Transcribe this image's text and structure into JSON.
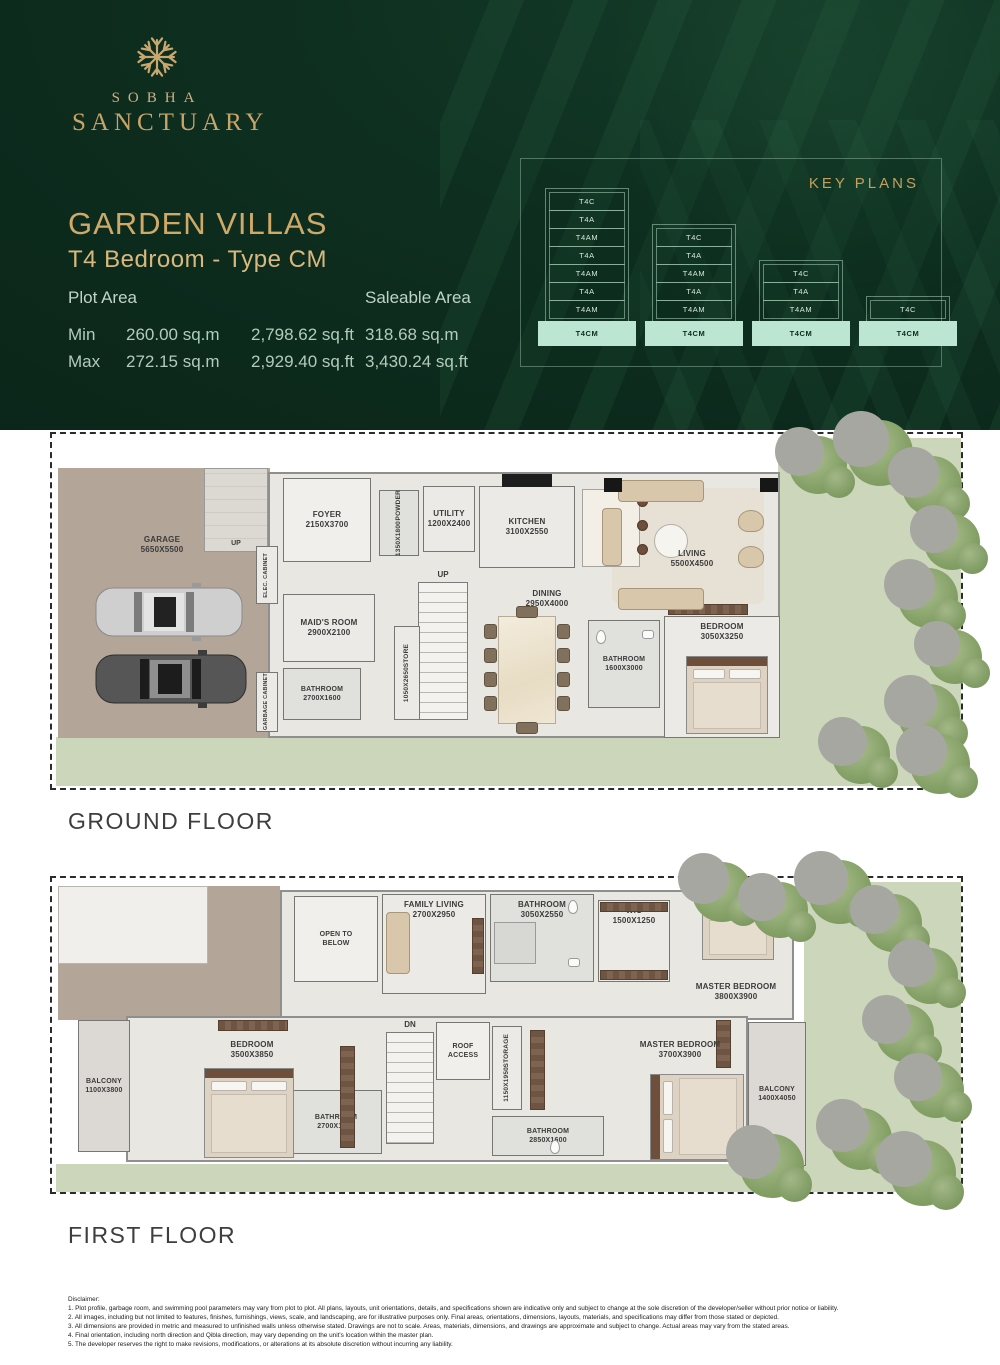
{
  "brand": {
    "name_top": "SOBHA",
    "name_bottom": "SANCTUARY"
  },
  "colors": {
    "header_green": "#0e2f20",
    "brand_gold": "#c9a468",
    "keyplan_highlight": "#bce6d1",
    "garden_green": "#ccd6ba",
    "garage_tan": "#b3a597"
  },
  "header": {
    "title": "GARDEN VILLAS",
    "subtitle": "T4 Bedroom - Type CM",
    "plot_area": {
      "label": "Plot Area",
      "rows": [
        {
          "key": "Min",
          "sqm": "260.00 sq.m",
          "sqft": "2,798.62 sq.ft"
        },
        {
          "key": "Max",
          "sqm": "272.15 sq.m",
          "sqft": "2,929.40 sq.ft"
        }
      ]
    },
    "saleable_area": {
      "label": "Saleable Area",
      "rows": [
        "318.68 sq.m",
        "3,430.24 sq.ft"
      ]
    }
  },
  "key_plans": {
    "title": "KEY PLANS",
    "stacks": [
      {
        "units": [
          "T4C",
          "T4A",
          "T4AM",
          "T4A",
          "T4AM",
          "T4A",
          "T4AM"
        ],
        "highlighted": "T4CM"
      },
      {
        "units": [
          "T4C",
          "T4A",
          "T4AM",
          "T4A",
          "T4AM"
        ],
        "highlighted": "T4CM"
      },
      {
        "units": [
          "T4C",
          "T4A",
          "T4AM"
        ],
        "highlighted": "T4CM"
      },
      {
        "units": [
          "T4C"
        ],
        "highlighted": "T4CM"
      }
    ]
  },
  "ground": {
    "label": "GROUND FLOOR",
    "rooms": {
      "garage": {
        "name": "GARAGE",
        "dim": "5650X5500"
      },
      "up_ramp": {
        "name": "UP"
      },
      "foyer": {
        "name": "FOYER",
        "dim": "2150X3700"
      },
      "elec_cabinet": {
        "name": "ELEC. CABINET"
      },
      "maids_room": {
        "name": "MAID'S ROOM",
        "dim": "2900X2100"
      },
      "bathroom1": {
        "name": "BATHROOM",
        "dim": "2700X1600"
      },
      "garbage_cabinet": {
        "name": "GARBAGE CABINET"
      },
      "powder": {
        "name": "POWDER",
        "dim": "1350X1800"
      },
      "utility": {
        "name": "UTILITY",
        "dim": "1200X2400"
      },
      "kitchen": {
        "name": "KITCHEN",
        "dim": "3100X2550"
      },
      "up_stairs": {
        "name": "UP"
      },
      "store": {
        "name": "STORE",
        "dim": "1050X2650"
      },
      "dining": {
        "name": "DINING",
        "dim": "2950X4000"
      },
      "bathroom2": {
        "name": "BATHROOM",
        "dim": "1600X3000"
      },
      "bedroom": {
        "name": "BEDROOM",
        "dim": "3050X3250"
      },
      "living": {
        "name": "LIVING",
        "dim": "5500X4500"
      }
    }
  },
  "first": {
    "label": "FIRST FLOOR",
    "rooms": {
      "open_to_below": {
        "name": "OPEN TO BELOW"
      },
      "family_living": {
        "name": "FAMILY LIVING",
        "dim": "2700X2950"
      },
      "bathroom1": {
        "name": "BATHROOM",
        "dim": "3050X2550"
      },
      "wic": {
        "name": "WIC",
        "dim": "1500X1250"
      },
      "master_bedroom1": {
        "name": "MASTER BEDROOM",
        "dim": "3800X3900"
      },
      "balcony1": {
        "name": "BALCONY",
        "dim": "1100X3800"
      },
      "bedroom": {
        "name": "BEDROOM",
        "dim": "3500X3850"
      },
      "bathroom2": {
        "name": "BATHROOM",
        "dim": "2700X1600"
      },
      "dn": {
        "name": "DN"
      },
      "roof_access": {
        "name": "ROOF ACCESS"
      },
      "storage": {
        "name": "STORAGE",
        "dim": "1150X1950"
      },
      "bathroom3": {
        "name": "BATHROOM",
        "dim": "2850X1600"
      },
      "master_bedroom2": {
        "name": "MASTER BEDROOM",
        "dim": "3700X3900"
      },
      "balcony2": {
        "name": "BALCONY",
        "dim": "1400X4050"
      }
    }
  },
  "disclaimer": {
    "title": "Disclaimer:",
    "lines": [
      "1. Plot profile, garbage room, and swimming pool parameters may vary from plot to plot. All plans, layouts, unit orientations, details, and specifications shown are indicative only and subject to change at the sole discretion of the developer/seller without prior notice or liability.",
      "2. All images, including but not limited to features, finishes, furnishings, views, scale, and landscaping, are for illustrative purposes only. Final areas, orientations, dimensions, layouts, materials, and specifications may differ from those stated or depicted.",
      "3. All dimensions are provided in metric and measured to unfinished walls unless otherwise stated. Drawings are not to scale. Areas, materials, dimensions, and drawings are approximate and subject to change. Actual areas may vary from the stated areas.",
      "4. Final orientation, including north direction and Qibla direction, may vary depending on the unit's location within the master plan.",
      "5. The developer reserves the right to make revisions, modifications, or alterations at its absolute discretion without incurring any liability."
    ]
  }
}
